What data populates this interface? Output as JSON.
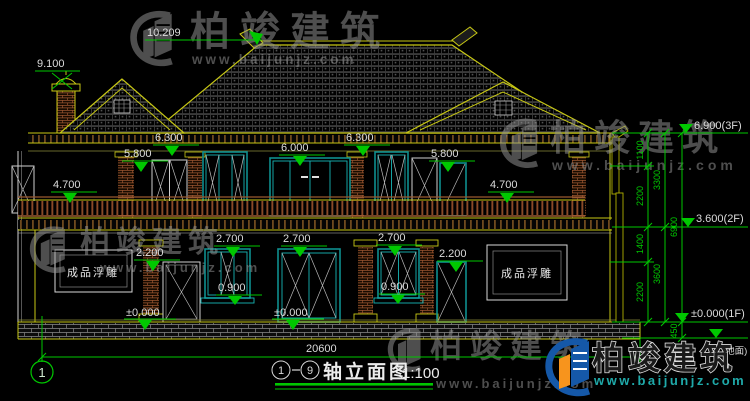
{
  "watermark": {
    "brand": "柏竣建筑",
    "url": "www.baijunjz.com"
  },
  "brand_logo": {
    "brand": "柏竣建筑",
    "url": "www.baijunjz.com"
  },
  "title_block": {
    "axis_start": "1",
    "axis_end": "9",
    "name": "轴立面图",
    "scale": "1:100"
  },
  "axis_bubble": {
    "label": "1"
  },
  "plaques": {
    "left": "成品浮雕",
    "right": "成品浮雕"
  },
  "dims": {
    "ridge": "10.209",
    "chimney": "9.100",
    "eave_left": "6.300",
    "eave_right": "6.300",
    "f2_center_door": "6.000",
    "f2_left_window": "5.800",
    "f2_right_door": "5.800",
    "balcony_left": "4.700",
    "balcony_right": "4.700",
    "f1_window_left_top": "2.700",
    "f1_door_center_top": "2.700",
    "f1_window_right_top": "2.700",
    "f1_door_left_top": "2.200",
    "f1_door_right_top": "2.200",
    "sill_left": "0.900",
    "sill_right": "0.900",
    "floor_left": "±0.000",
    "floor_center": "±0.000",
    "total_width": "20600"
  },
  "levels": {
    "roof": "6.900(3F)",
    "second": "3.600(2F)",
    "first": "±0.000(1F)",
    "ground": "(地面)"
  },
  "vdims": {
    "seg1": "1100",
    "seg2": "2200",
    "seg3": "1400",
    "seg4": "2200",
    "seg5": "450",
    "sub1": "3300",
    "sub2": "3600",
    "total": "6900"
  },
  "colors": {
    "background": "#000000",
    "cad_yellow": "#c8c814",
    "dim_green": "#00c800",
    "window_teal": "#0e8f8f",
    "wood_brown": "#8a4a28",
    "text_white": "#dcdcdc",
    "logo_blue": "#1558a8",
    "logo_orange": "#f7941d",
    "logo_cyan": "#1fa9a9"
  }
}
